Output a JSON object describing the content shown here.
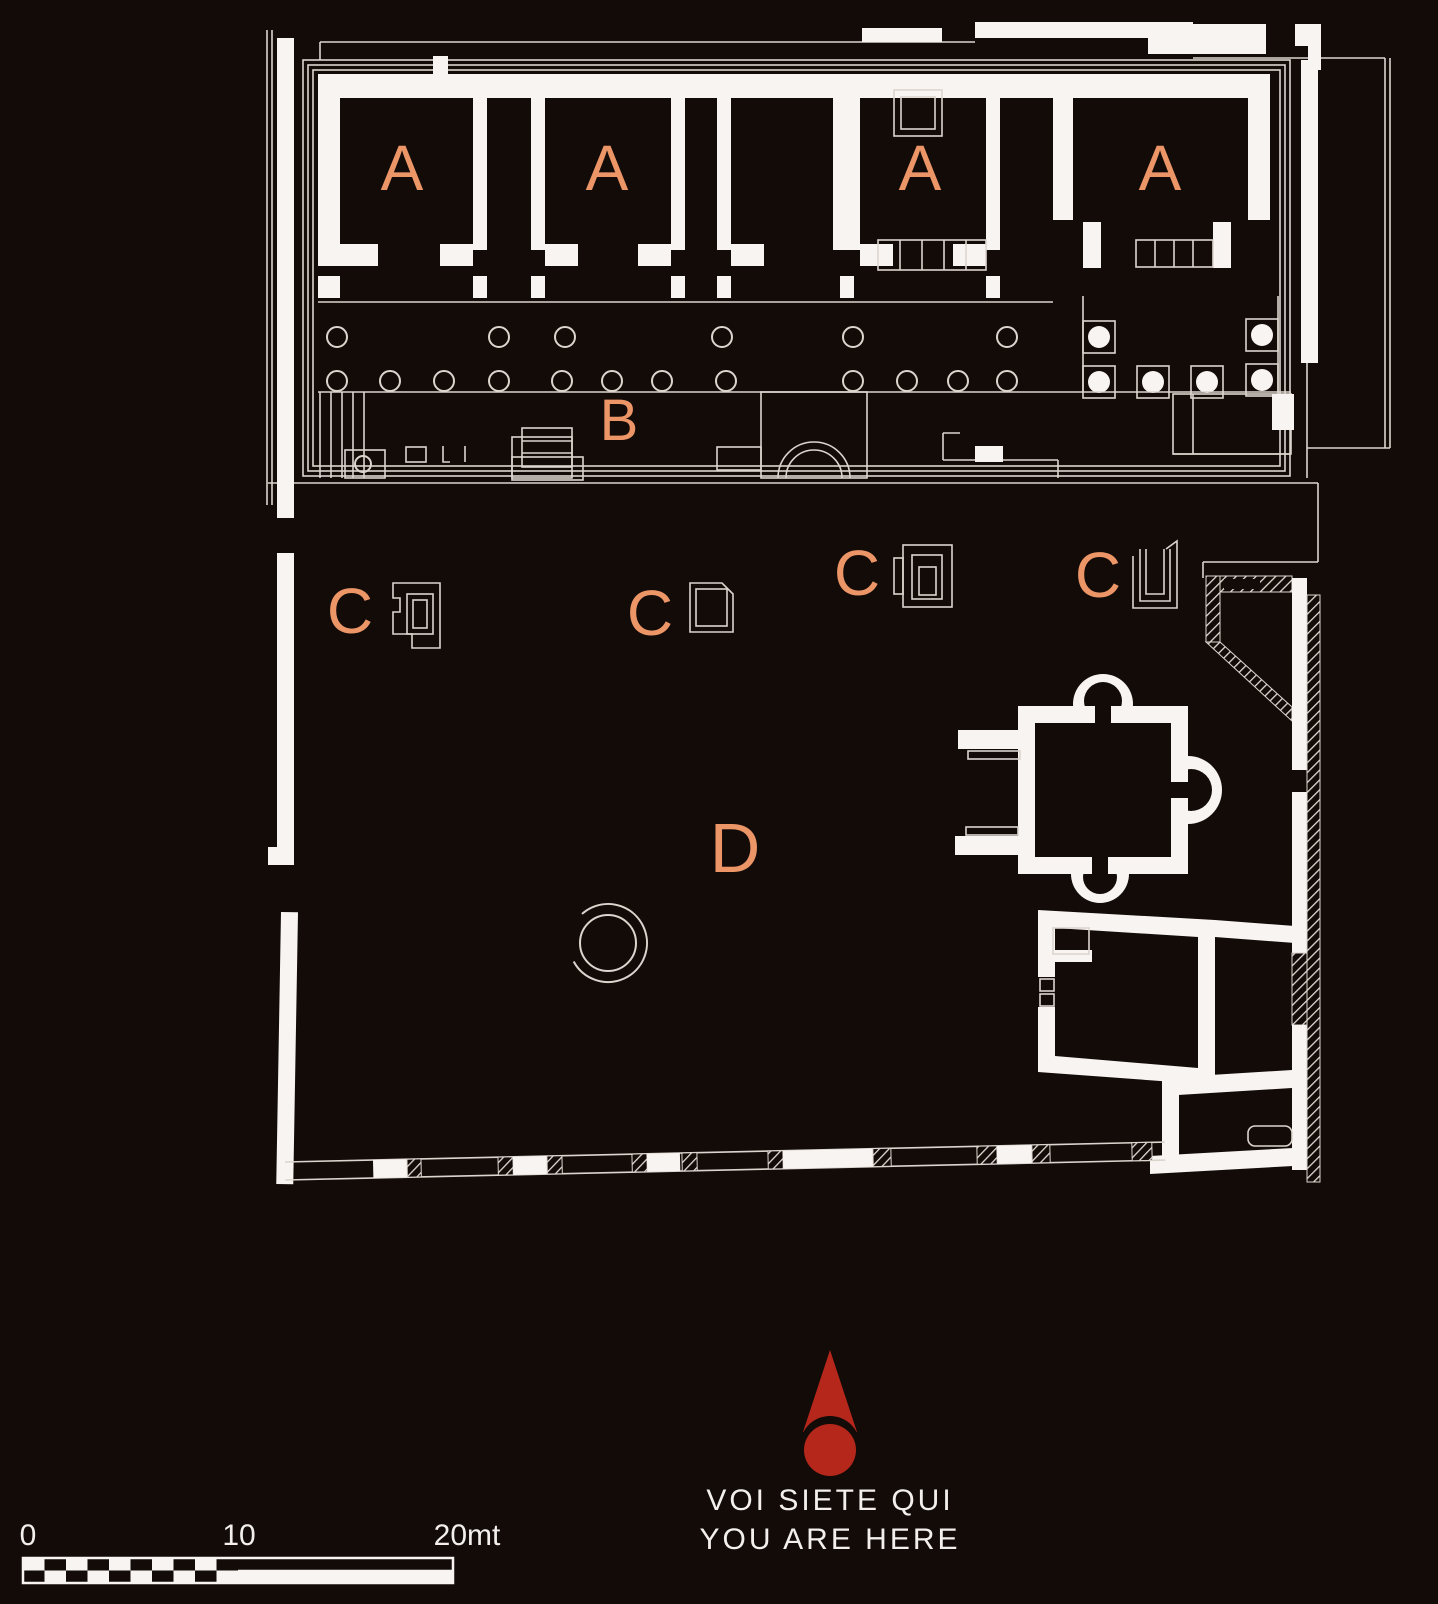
{
  "colors": {
    "background": "#130B08",
    "line": "#DCD5CE",
    "wall": "#F7F4F1",
    "accent": "#EC9668",
    "marker_red": "#B5271B",
    "text": "#F2EFEC"
  },
  "labels": {
    "a1": "A",
    "a2": "A",
    "a3": "A",
    "a4": "A",
    "b": "B",
    "c1": "C",
    "c2": "C",
    "c3": "C",
    "c4": "C",
    "d": "D"
  },
  "marker": {
    "line1": "VOI SIETE QUI",
    "line2": "YOU ARE HERE"
  },
  "scale_bar": {
    "start": "0",
    "middle": "10",
    "end": "20mt"
  }
}
